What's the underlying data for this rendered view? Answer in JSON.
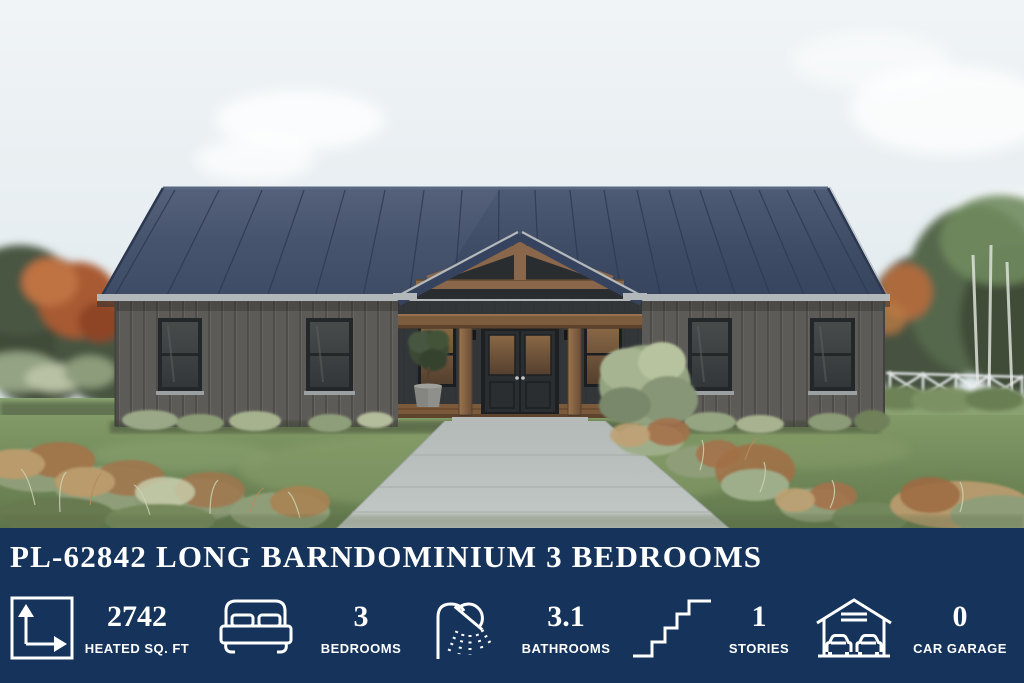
{
  "banner": {
    "title": "PL-62842 LONG BARNDOMINIUM 3 BEDROOMS",
    "colors": {
      "background": "#16345B",
      "text": "#FFFFFF"
    },
    "stats": [
      {
        "icon": "floor-area-icon",
        "value": "2742",
        "label": "HEATED SQ. FT"
      },
      {
        "icon": "bed-icon",
        "value": "3",
        "label": "BEDROOMS"
      },
      {
        "icon": "shower-icon",
        "value": "3.1",
        "label": "BATHROOMS"
      },
      {
        "icon": "stairs-icon",
        "value": "1",
        "label": "STORIES"
      },
      {
        "icon": "garage-icon",
        "value": "0",
        "label": "CAR GARAGE"
      }
    ]
  },
  "scene": {
    "colors": {
      "sky": "#E8EEF2",
      "metal_roof": "#3E4C66",
      "siding": "#5E5C58",
      "wood_accent": "#8A674A",
      "front_door": "#2C2F31",
      "window_glass_amber": "#7A5A3C",
      "walkway_concrete": "#B8BFBD",
      "lawn": "#77915F",
      "autumn_foliage": "#B06537",
      "fence_white": "#E9ECEE"
    }
  }
}
